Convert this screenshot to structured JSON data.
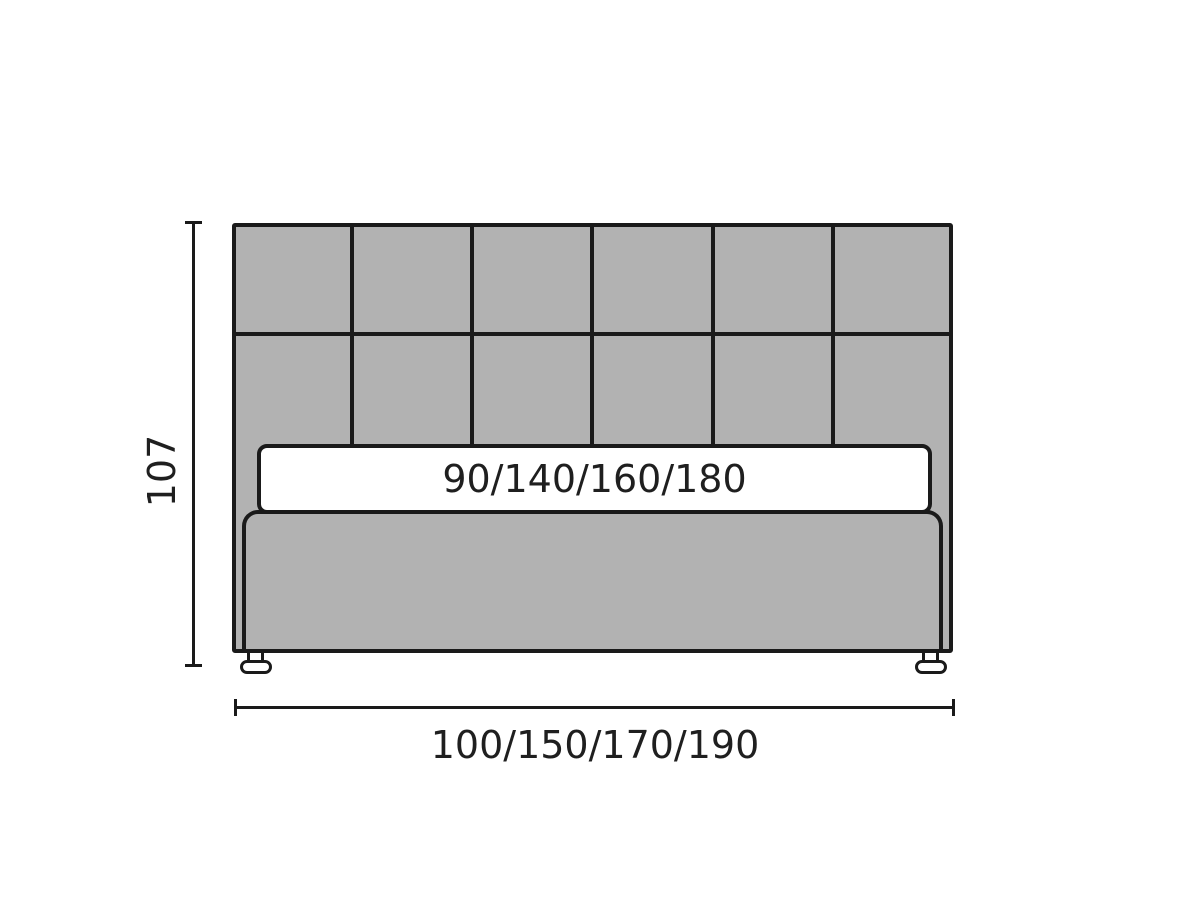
{
  "diagram": {
    "type": "furniture-dimension-diagram",
    "subject": "front view of an upholstered bed with square-tufted headboard, mattress and two feet",
    "height_label": "107",
    "width_label": "100/150/170/190",
    "mattress_label": "90/140/160/180",
    "headboard_grid": {
      "columns": 6,
      "rows": 2
    },
    "colors": {
      "upholstery_fill": "#b2b2b2",
      "outline": "#1a1a1a",
      "mattress_fill": "#ffffff",
      "background": "#ffffff",
      "text": "#1f1f1f"
    }
  }
}
